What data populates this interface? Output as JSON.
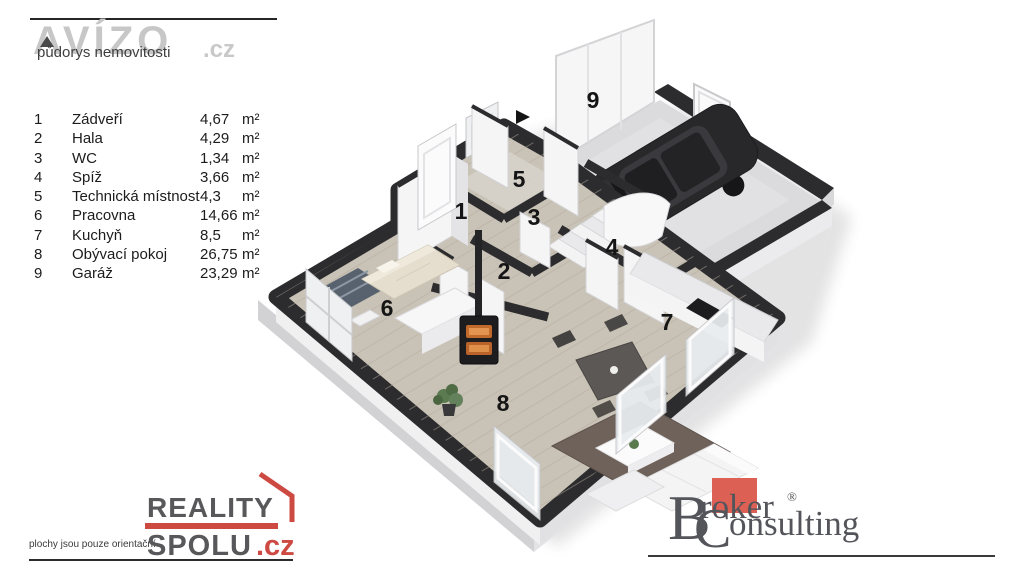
{
  "header": {
    "brand": "AVÍZO",
    "brand_tld": ".cz",
    "subtitle": "půdorys nemovitosti"
  },
  "legend": {
    "rooms": [
      {
        "num": "1",
        "name": "Zádveří",
        "area": "4,67",
        "unit": "m²"
      },
      {
        "num": "2",
        "name": "Hala",
        "area": "4,29",
        "unit": "m²"
      },
      {
        "num": "3",
        "name": "WC",
        "area": "1,34",
        "unit": "m²"
      },
      {
        "num": "4",
        "name": "Spíž",
        "area": "3,66",
        "unit": "m²"
      },
      {
        "num": "5",
        "name": "Technická místnost",
        "area": "4,3",
        "unit": "m²"
      },
      {
        "num": "6",
        "name": "Pracovna",
        "area": "14,66",
        "unit": "m²"
      },
      {
        "num": "7",
        "name": "Kuchyň",
        "area": "8,5",
        "unit": "m²"
      },
      {
        "num": "8",
        "name": "Obývací pokoj",
        "area": "26,75",
        "unit": "m²"
      },
      {
        "num": "9",
        "name": "Garáž",
        "area": "23,29",
        "unit": "m²"
      }
    ]
  },
  "floorplan": {
    "room_labels": [
      "1",
      "2",
      "3",
      "4",
      "5",
      "6",
      "7",
      "8",
      "9"
    ]
  },
  "footer_left": {
    "disclaimer": "plochy jsou pouze orientační",
    "brand_top": "REALITY",
    "brand_bottom": "SPOLU",
    "brand_tld": ".cz"
  },
  "footer_right": {
    "brand_top": "Broker",
    "brand_bottom": "Consulting",
    "registered": "®"
  },
  "colors": {
    "accent_red": "#cd4a42",
    "broker_red": "#dd6055",
    "wall_dark": "#2c2c2e",
    "floor_wood": "#c9c2b6",
    "garage_floor": "#dbdbdd",
    "fire_orange": "#c26a2b"
  }
}
